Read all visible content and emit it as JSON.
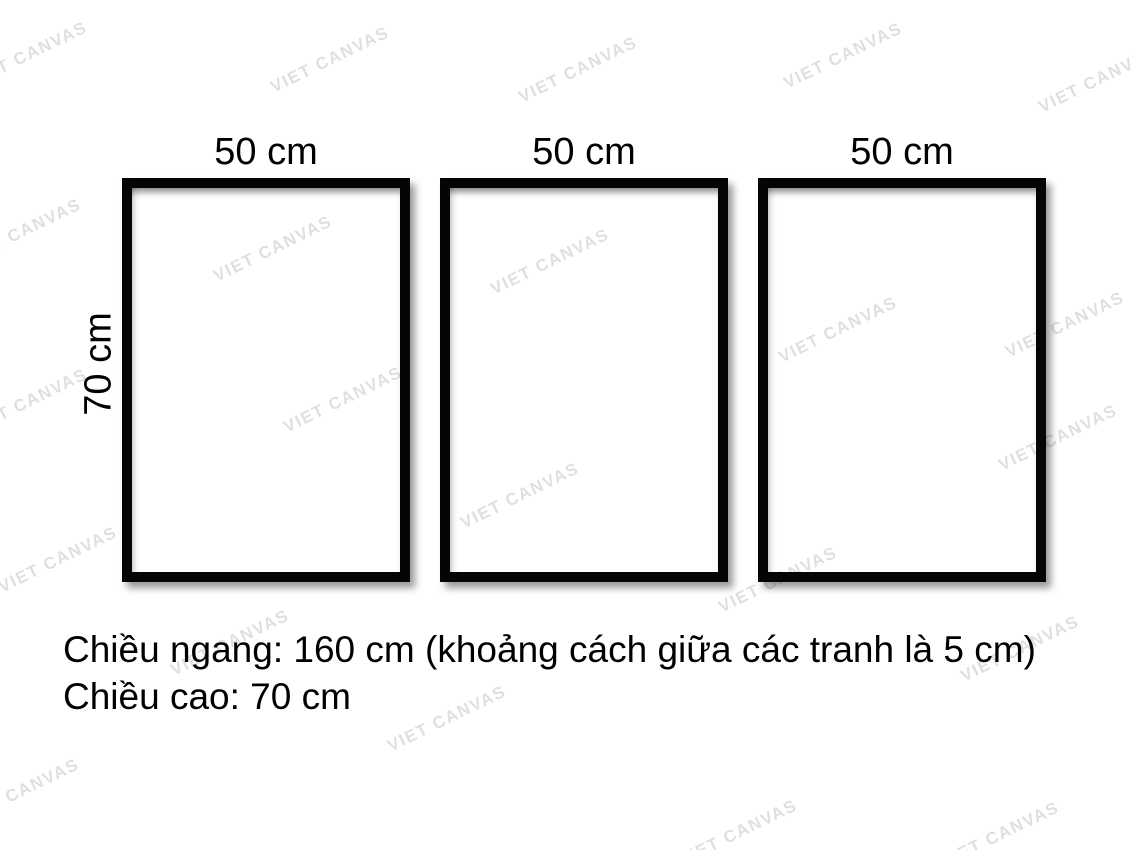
{
  "diagram": {
    "frames": [
      {
        "width_label": "50 cm"
      },
      {
        "width_label": "50 cm"
      },
      {
        "width_label": "50 cm"
      }
    ],
    "height_label": "70 cm",
    "caption_line1": "Chiều ngang: 160 cm (khoảng cách giữa các tranh là 5 cm)",
    "caption_line2": "Chiều cao: 70 cm"
  },
  "watermark": {
    "text": "VIET CANVAS",
    "color": "#000000",
    "opacity": 0.12,
    "positions": [
      {
        "x": 28,
        "y": 55
      },
      {
        "x": 330,
        "y": 60
      },
      {
        "x": 578,
        "y": 70
      },
      {
        "x": 843,
        "y": 56
      },
      {
        "x": 1098,
        "y": 80
      },
      {
        "x": 22,
        "y": 232
      },
      {
        "x": 273,
        "y": 249
      },
      {
        "x": 550,
        "y": 262
      },
      {
        "x": 838,
        "y": 330
      },
      {
        "x": 1065,
        "y": 325
      },
      {
        "x": 28,
        "y": 402
      },
      {
        "x": 343,
        "y": 400
      },
      {
        "x": 520,
        "y": 496
      },
      {
        "x": 1058,
        "y": 438
      },
      {
        "x": 58,
        "y": 560
      },
      {
        "x": 778,
        "y": 580
      },
      {
        "x": 230,
        "y": 643
      },
      {
        "x": 1020,
        "y": 649
      },
      {
        "x": 447,
        "y": 719
      },
      {
        "x": 20,
        "y": 792
      },
      {
        "x": 738,
        "y": 833
      },
      {
        "x": 1000,
        "y": 835
      }
    ]
  },
  "colors": {
    "background": "#ffffff",
    "frame_border": "#050505",
    "text": "#000000"
  }
}
